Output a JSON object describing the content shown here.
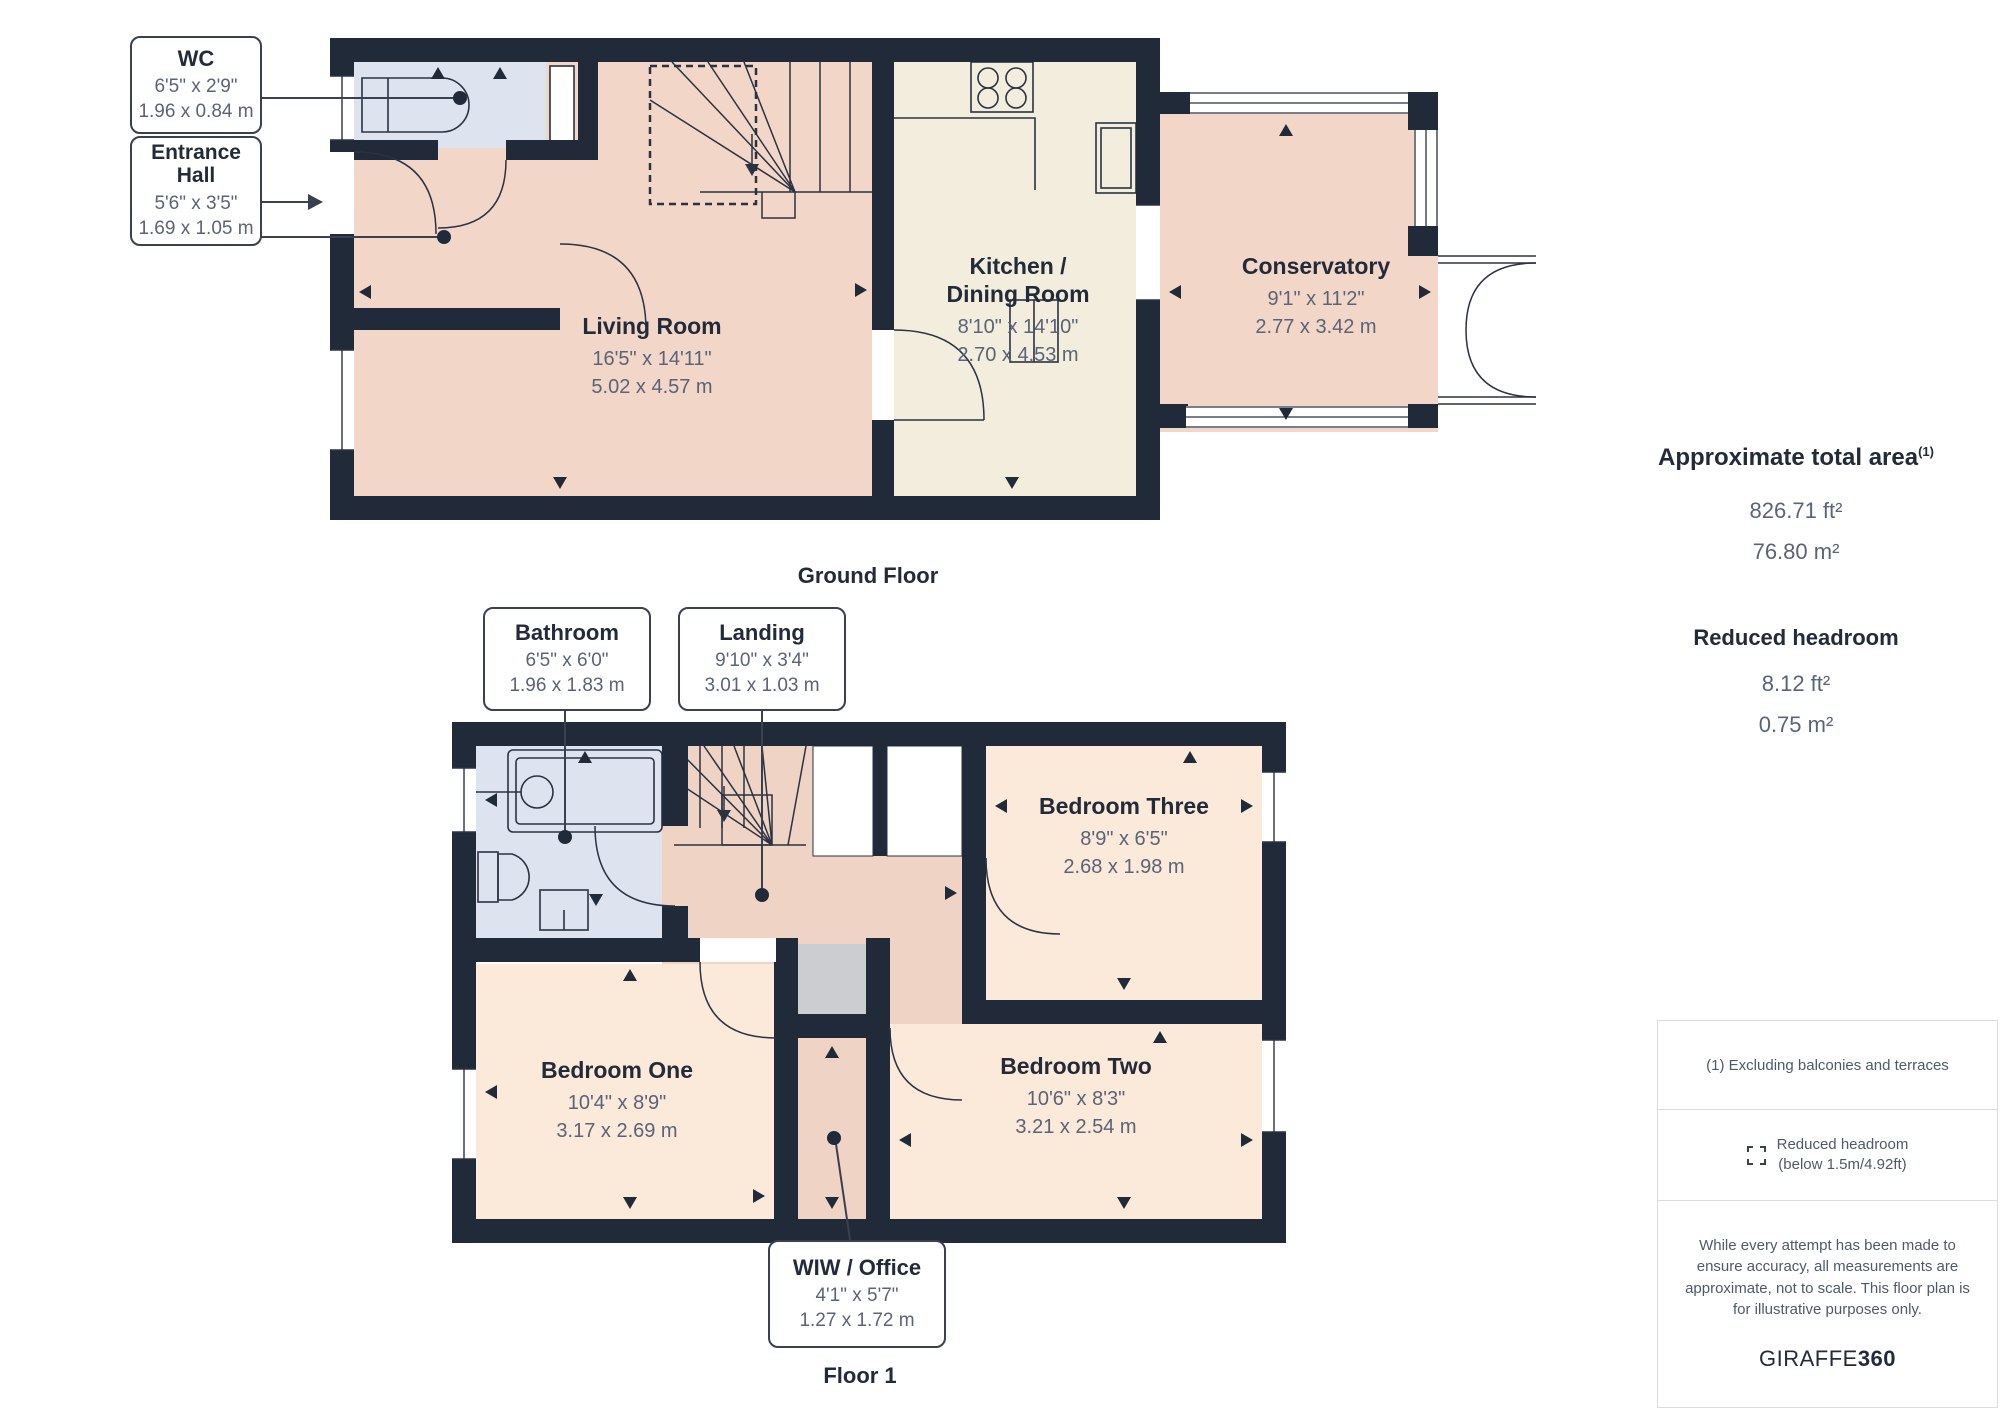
{
  "palette": {
    "wall": "#212A38",
    "line": "#2A3243",
    "room_pink": "#F2D7C8",
    "room_peach": "#FBE9DA",
    "room_cream": "#F2EDDC",
    "room_blue": "#DEE4EF",
    "void_gray": "#CBCDD1",
    "text_dark": "#232B3B",
    "text_gray": "#5A6377"
  },
  "ground_floor": {
    "caption": "Ground Floor",
    "rooms": {
      "living_room": {
        "name": "Living Room",
        "dims_ft": "16'5\" x 14'11\"",
        "dims_m": "5.02 x 4.57 m"
      },
      "kitchen": {
        "name": "Kitchen / Dining Room",
        "dims_ft": "8'10\" x 14'10\"",
        "dims_m": "2.70 x 4.53 m"
      },
      "conservatory": {
        "name": "Conservatory",
        "dims_ft": "9'1\" x 11'2\"",
        "dims_m": "2.77 x 3.42 m"
      }
    },
    "callouts": {
      "wc": {
        "name": "WC",
        "dims_ft": "6'5\" x 2'9\"",
        "dims_m": "1.96 x 0.84 m"
      },
      "entrance_hall": {
        "name": "Entrance Hall",
        "dims_ft": "5'6\" x 3'5\"",
        "dims_m": "1.69 x 1.05 m"
      }
    }
  },
  "floor_1": {
    "caption": "Floor 1",
    "rooms": {
      "bedroom_one": {
        "name": "Bedroom One",
        "dims_ft": "10'4\" x 8'9\"",
        "dims_m": "3.17 x 2.69 m"
      },
      "bedroom_two": {
        "name": "Bedroom Two",
        "dims_ft": "10'6\" x 8'3\"",
        "dims_m": "3.21 x 2.54 m"
      },
      "bedroom_three": {
        "name": "Bedroom Three",
        "dims_ft": "8'9\" x 6'5\"",
        "dims_m": "2.68 x 1.98 m"
      }
    },
    "callouts": {
      "bathroom": {
        "name": "Bathroom",
        "dims_ft": "6'5\" x 6'0\"",
        "dims_m": "1.96 x 1.83 m"
      },
      "landing": {
        "name": "Landing",
        "dims_ft": "9'10\" x 3'4\"",
        "dims_m": "3.01 x 1.03 m"
      },
      "wiw_office": {
        "name": "WIW / Office",
        "dims_ft": "4'1\" x 5'7\"",
        "dims_m": "1.27 x 1.72 m"
      }
    }
  },
  "summary": {
    "total_area_label": "Approximate total area",
    "total_area_footnote_marker": "(1)",
    "total_area_ft": "826.71 ft²",
    "total_area_m": "76.80 m²",
    "reduced_headroom_label": "Reduced headroom",
    "reduced_headroom_ft": "8.12 ft²",
    "reduced_headroom_m": "0.75 m²"
  },
  "notes": {
    "footnote": "(1) Excluding balconies and terraces",
    "legend_label_line1": "Reduced headroom",
    "legend_label_line2": "(below 1.5m/4.92ft)",
    "disclaimer": "While every attempt has been made to ensure accuracy, all measurements are approximate, not to scale. This floor plan is for illustrative purposes only.",
    "brand_name": "GIRAFFE",
    "brand_suffix": "360"
  }
}
